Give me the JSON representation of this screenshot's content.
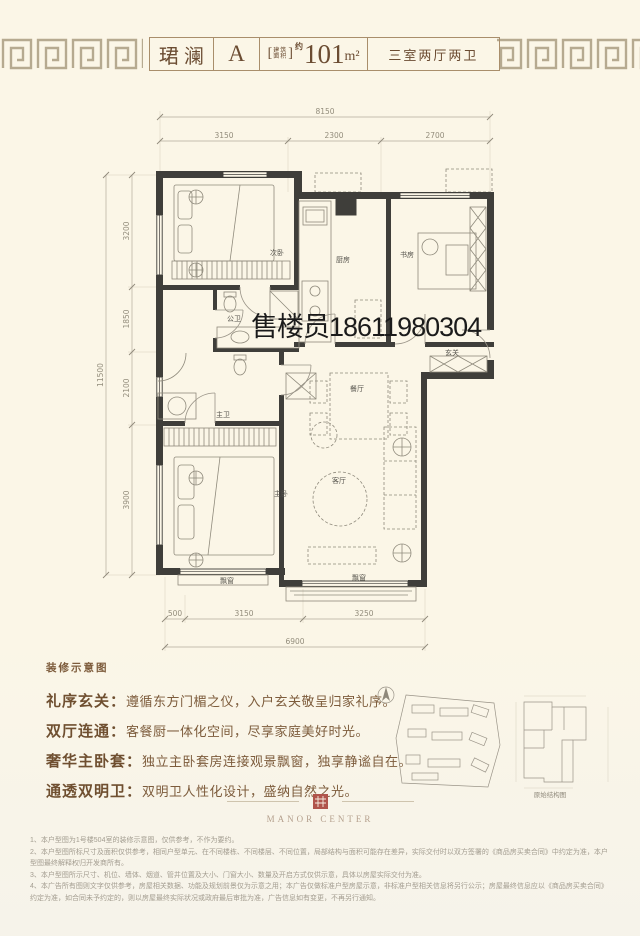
{
  "header": {
    "title": "珺澜",
    "unit": "A",
    "bracket_open": "[",
    "bracket_close": "]",
    "area_label_top": "建筑",
    "area_label_bottom": "面积",
    "area_approx": "约",
    "area_number": "101",
    "area_unit": "m²",
    "layout_type": "三室两厅两卫"
  },
  "watermark": "售楼员18611980304",
  "plan": {
    "rooms": [
      "次卧",
      "厨房",
      "书房",
      "公卫",
      "玄关",
      "餐厅",
      "主卫",
      "主卧",
      "客厅"
    ],
    "bay_window": "飘窗",
    "dim_top_total": "8150",
    "dims_top": [
      "3150",
      "2300",
      "2700"
    ],
    "dim_left_total": "11500",
    "dims_left": [
      "3200",
      "1850",
      "2100",
      "3900"
    ],
    "dims_bottom": [
      "500",
      "3150",
      "3250"
    ],
    "dim_bottom_total": "6900"
  },
  "caption": "装修示意图",
  "features": [
    {
      "label": "礼序玄关：",
      "text": "遵循东方门楣之仪，入户玄关敬呈归家礼序。"
    },
    {
      "label": "双厅连通：",
      "text": "客餐厨一体化空间，尽享家庭美好时光。"
    },
    {
      "label": "奢华主卧套：",
      "text": "独立主卧套房连接观景飘窗，独享静谧自在。"
    },
    {
      "label": "通透双明卫：",
      "text": "双明卫人性化设计，盛纳自然之光。"
    }
  ],
  "minimap": {
    "structure_label": "原始结构图"
  },
  "logo": {
    "name": "MANOR CENTER"
  },
  "disclaimers": [
    "1、本户型图为1号楼504室的装修示意图，仅供参考，不作为要约。",
    "2、本户型图所标尺寸及面积仅供参考，相同户型单元、在不同楼栋、不同楼层、不同位置，局部结构与面积可能存在差异，实际交付时以双方签署的《商品房买卖合同》中约定为准，本户型图最终解释权归开发商所有。",
    "3、本户型图所示尺寸、机位、墙体、烟道、管井位置及大小、门窗大小、数量及开启方式仅供示意，具体以房屋实际交付为准。",
    "4、本广告所有图则文字仅供参考，房屋相关数据、功能及规划前景仅为示意之用；本广告仅做标准户型房屋示意，非标准户型相关信息将另行公示；房屋最终信息应以《商品房买卖合同》约定为准，如合同未予约定的，则以房屋最终实际状况或政府最后审批为准，广告信息如有变更，不再另行通知。"
  ],
  "colors": {
    "accent_red": "#b0544b",
    "brown": "#7a5a3e",
    "wall": "#3f3e3a"
  }
}
